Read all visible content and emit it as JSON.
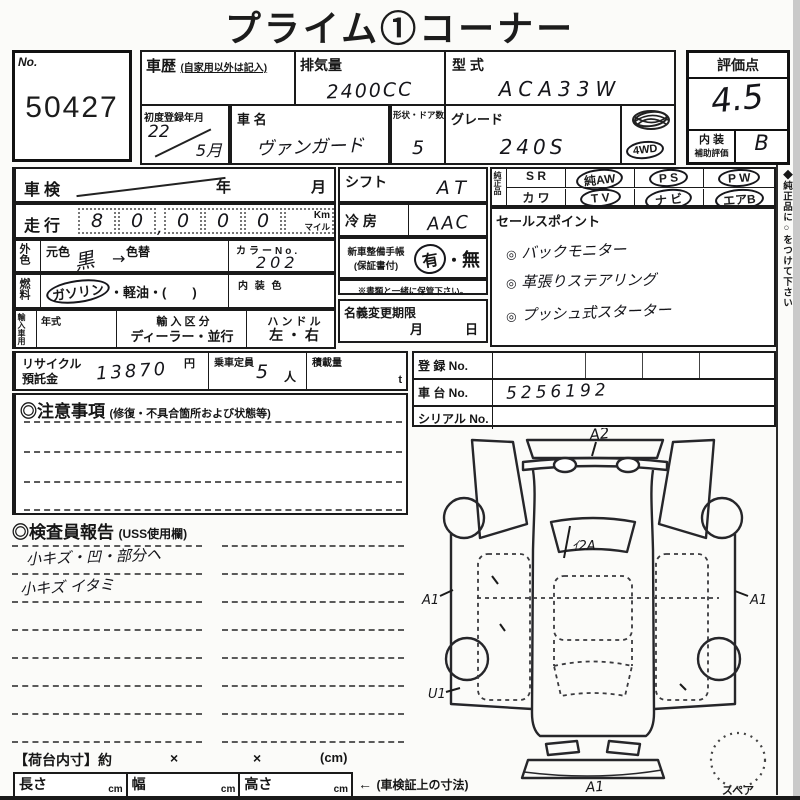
{
  "title": "プライム①コーナー",
  "lot": {
    "label": "No.",
    "number": "50427"
  },
  "vehicle": {
    "history_label": "車歴",
    "history_note": "(自家用以外は記入)",
    "displacement_label": "排気量",
    "displacement": "2400CC",
    "model_label": "型 式",
    "model": "ACA33W",
    "first_reg_label": "初度登録年月",
    "first_reg_year": "22",
    "first_reg_month": "5月",
    "name_label": "車 名",
    "name": "ヴァンガード",
    "doors_label": "形状・ドア数",
    "doors": "5",
    "grade_label": "グレード",
    "grade": "240S",
    "drive_badge": "4WD"
  },
  "score": {
    "label": "評価点",
    "value": "4.5",
    "interior_label1": "内 装",
    "interior_label2": "補助評価",
    "interior_value": "B"
  },
  "shaken": {
    "label": "車検",
    "year_label": "年",
    "month_label": "月"
  },
  "mileage": {
    "label": "走行",
    "digits": [
      "8",
      "0",
      "0",
      "0",
      "0"
    ],
    "comma": ",",
    "unit_top": "Km",
    "unit_bottom": "マイル"
  },
  "exterior": {
    "label": "外色",
    "orig_label": "元色",
    "change_label": "色替",
    "orig_value": "黒",
    "arrow": "→",
    "color_no_label": "カラーNo.",
    "color_no": "202"
  },
  "fuel": {
    "label": "燃料",
    "option_selected": "ガソリン",
    "options_rest": "・軽油・(　　)",
    "interior_color_label": "内 装 色"
  },
  "import_row": {
    "label": "輸入車用",
    "year_label": "年式",
    "division_label": "輸 入 区 分",
    "division_options": "ディーラー・並行",
    "handle_label": "ハ ン ド ル",
    "handle_options": "左 ・ 右"
  },
  "recycle": {
    "label1": "リサイクル",
    "label2": "預託金",
    "value": "13870",
    "unit": "円",
    "capacity_label": "乗車定員",
    "capacity_value": "5",
    "capacity_unit": "人",
    "load_label": "積載量",
    "load_unit": "t"
  },
  "caution": {
    "label": "◎注意事項",
    "note": "(修復・不具合箇所および状態等)"
  },
  "equipment": {
    "shift_label": "シフト",
    "shift_value": "AT",
    "ac_label": "冷 房",
    "ac_value": "AAC",
    "handbook_label1": "新車整備手帳",
    "handbook_label2": "(保証書付)",
    "handbook_yes": "有",
    "handbook_dot": "・",
    "handbook_no": "無",
    "handbook_note": "※書類と一緒に保管下さい。",
    "transfer_label": "名義変更期限",
    "transfer_month": "月",
    "transfer_day": "日"
  },
  "oem": {
    "label": "純正品",
    "r1": [
      "S R",
      "純AW",
      "P S",
      "P W"
    ],
    "r2": [
      "カ ワ",
      "T V",
      "ナ ビ",
      "エアB"
    ]
  },
  "sales": {
    "label": "セールスポイント",
    "mark": "◎",
    "points": [
      "バックモニター",
      "革張りステアリング",
      "プッシュ式スターター"
    ]
  },
  "registration": {
    "reg_label": "登 録 No.",
    "chassis_label": "車 台 No.",
    "chassis_value": "5256192",
    "serial_label": "シリアル No."
  },
  "inspector": {
    "label": "◎検査員報告",
    "note": "(USS使用欄)",
    "line1": "小キズ・凹・部分ヘ",
    "line2": "小キズ イタミ"
  },
  "cargo": {
    "label": "【荷台内寸】約",
    "times1": "×",
    "times2": "×",
    "unit": "(cm)"
  },
  "dims": {
    "length_label": "長さ",
    "width_label": "幅",
    "height_label": "高さ",
    "unit": "cm",
    "arrow": "←",
    "note": "(車検証上の寸法)"
  },
  "diagram": {
    "mark_top": "A2",
    "mark_rear_window": "ｲ2A",
    "mark_left": "A1",
    "mark_right": "A1",
    "mark_bottom_left": "U1",
    "mark_bottom": "A1",
    "spare_label": "スペア"
  },
  "side_note": "◆純正品に○をつけて下さい"
}
